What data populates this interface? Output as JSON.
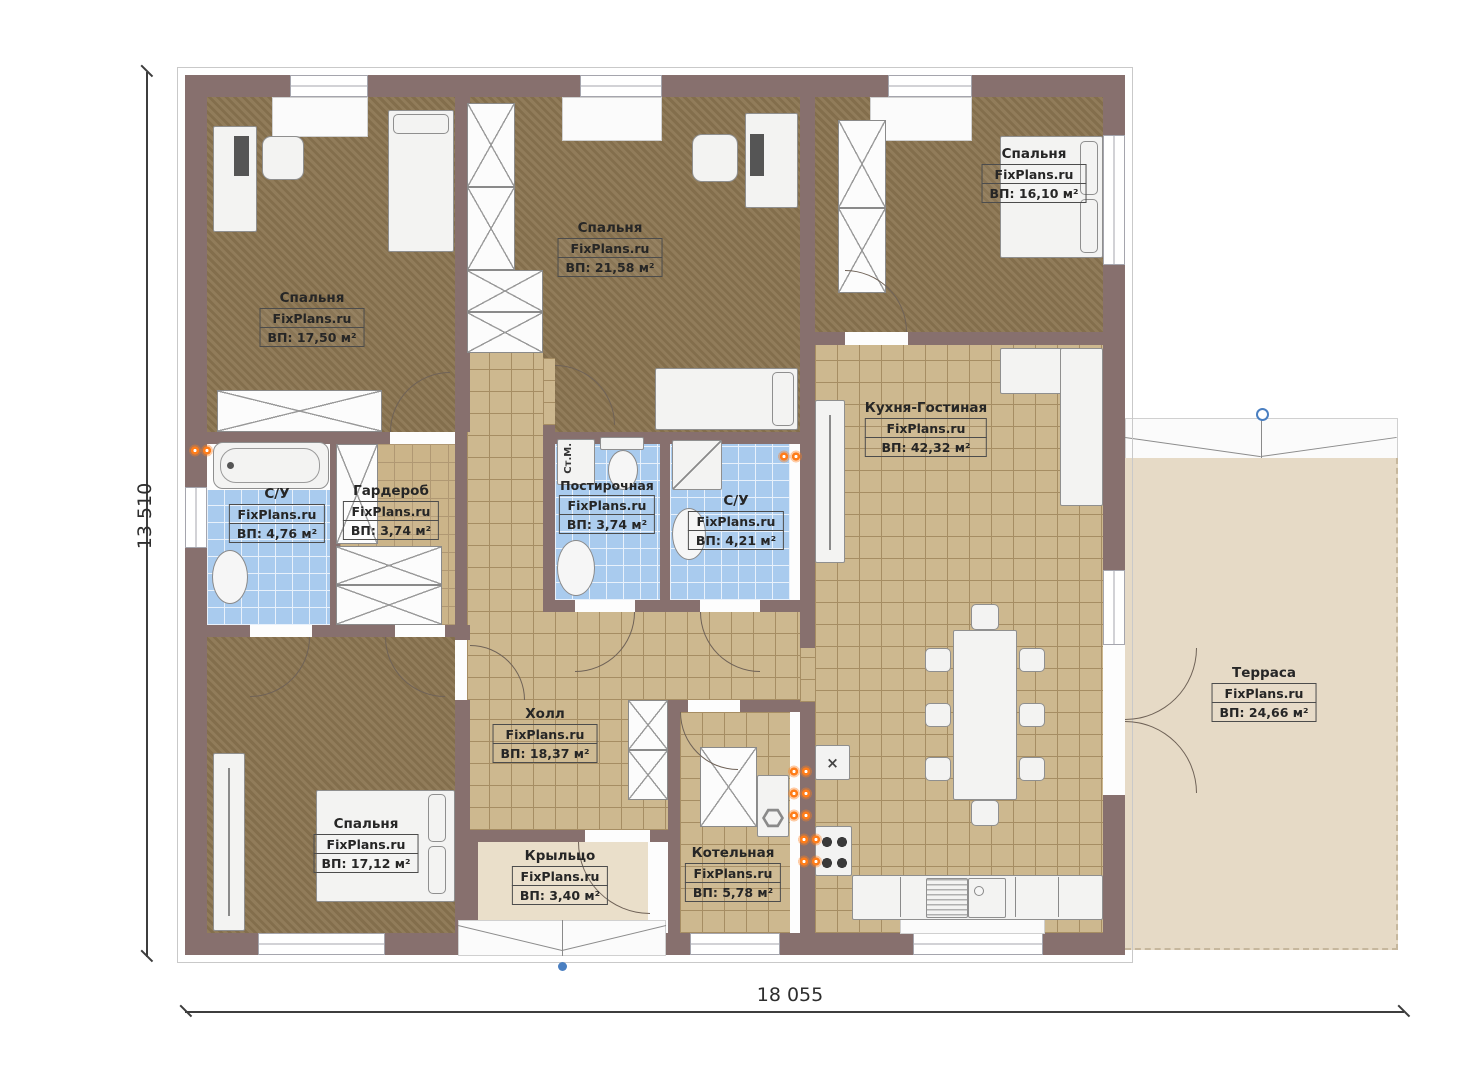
{
  "dimensions": {
    "bottom": "18 055",
    "left": "13 510"
  },
  "rooms": [
    {
      "name": "Спальня",
      "brand": "FixPlans.ru",
      "area": "ВП: 17,50 м²"
    },
    {
      "name": "Спальня",
      "brand": "FixPlans.ru",
      "area": "ВП: 21,58 м²"
    },
    {
      "name": "Спальня",
      "brand": "FixPlans.ru",
      "area": "ВП: 16,10 м²"
    },
    {
      "name": "Кухня-Гостиная",
      "brand": "FixPlans.ru",
      "area": "ВП: 42,32 м²"
    },
    {
      "name": "С/У",
      "brand": "FixPlans.ru",
      "area": "ВП: 4,76 м²"
    },
    {
      "name": "Гардероб",
      "brand": "FixPlans.ru",
      "area": "ВП: 3,74 м²"
    },
    {
      "name": "Постирочная",
      "brand": "FixPlans.ru",
      "area": "ВП: 3,74 м²"
    },
    {
      "name": "С/У",
      "brand": "FixPlans.ru",
      "area": "ВП: 4,21 м²"
    },
    {
      "name": "Холл",
      "brand": "FixPlans.ru",
      "area": "ВП: 18,37 м²"
    },
    {
      "name": "Спальня",
      "brand": "FixPlans.ru",
      "area": "ВП: 17,12 м²"
    },
    {
      "name": "Крыльцо",
      "brand": "FixPlans.ru",
      "area": "ВП: 3,40 м²"
    },
    {
      "name": "Котельная",
      "brand": "FixPlans.ru",
      "area": "ВП: 5,78 м²"
    },
    {
      "name": "Терраса",
      "brand": "FixPlans.ru",
      "area": "ВП: 24,66 м²"
    }
  ],
  "labels": {
    "washing_machine": "Ст.М."
  },
  "icons": {
    "extractor": "×"
  },
  "palette": {
    "wall": "#87706e",
    "carpet": "#8b7551",
    "tile": "#cdb88f",
    "tile_line": "#a68d63",
    "tile2": "#cbb489",
    "wet": "#a9cbee",
    "wet_line": "#e8f1fb",
    "terrace": "#e6dac6",
    "porch": "#eadfca",
    "furniture": "#f3f3f2",
    "label": "#262626",
    "radiator": "#ff7d1a",
    "marker": "#4a7fc1",
    "arc": "#6f6257"
  }
}
